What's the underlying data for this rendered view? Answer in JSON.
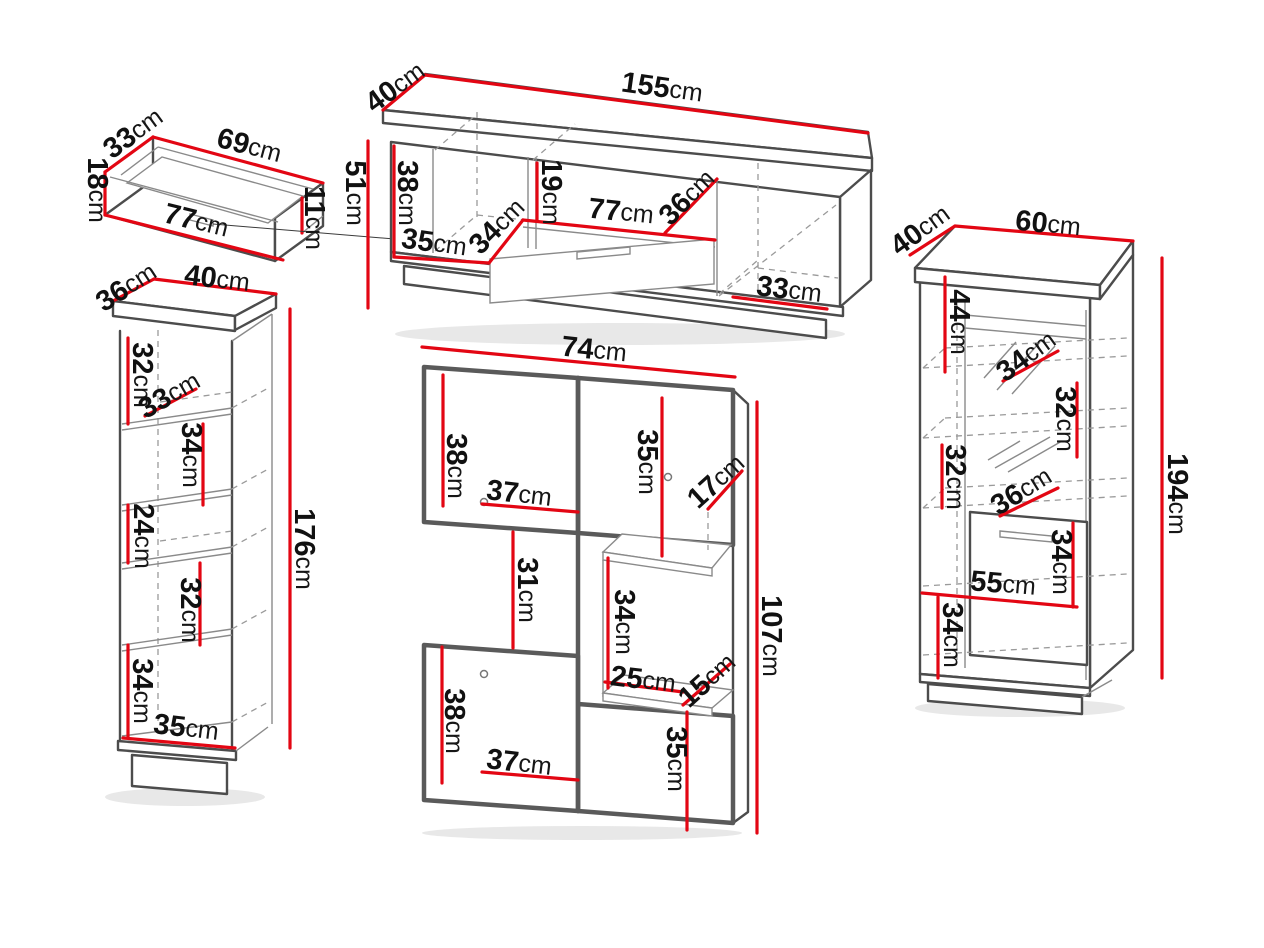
{
  "title": "Furniture wall unit set dimension diagram",
  "unit": "cm",
  "colors": {
    "dimension_red": "#e30613",
    "outline_dark": "#4c4c4c",
    "outline_light": "#8a8a8a",
    "background": "#ffffff",
    "text": "#111111"
  },
  "pieces": {
    "wall_shelf": {
      "name": "wall shelf",
      "dims": {
        "depth": {
          "v": "33",
          "u": "cm"
        },
        "top_width": {
          "v": "69",
          "u": "cm"
        },
        "height": {
          "v": "18",
          "u": "cm"
        },
        "front_width": {
          "v": "77",
          "u": "cm"
        },
        "side_height": {
          "v": "11",
          "u": "cm"
        }
      }
    },
    "tv_stand": {
      "name": "TV stand",
      "dims": {
        "depth": {
          "v": "40",
          "u": "cm"
        },
        "width": {
          "v": "155",
          "u": "cm"
        },
        "height": {
          "v": "51",
          "u": "cm"
        },
        "inner_height": {
          "v": "38",
          "u": "cm"
        },
        "left_width": {
          "v": "35",
          "u": "cm"
        },
        "left_depth": {
          "v": "34",
          "u": "cm"
        },
        "niche_height": {
          "v": "19",
          "u": "cm"
        },
        "niche_width": {
          "v": "77",
          "u": "cm"
        },
        "right_depth": {
          "v": "36",
          "u": "cm"
        },
        "right_width": {
          "v": "33",
          "u": "cm"
        }
      }
    },
    "bookcase": {
      "name": "open bookcase",
      "dims": {
        "depth": {
          "v": "36",
          "u": "cm"
        },
        "width": {
          "v": "40",
          "u": "cm"
        },
        "sec1_height": {
          "v": "32",
          "u": "cm"
        },
        "shelf_depth": {
          "v": "33",
          "u": "cm"
        },
        "sec2_height": {
          "v": "34",
          "u": "cm"
        },
        "sec3_height": {
          "v": "24",
          "u": "cm"
        },
        "sec4_height": {
          "v": "32",
          "u": "cm"
        },
        "sec5_height": {
          "v": "34",
          "u": "cm"
        },
        "interior_width": {
          "v": "35",
          "u": "cm"
        },
        "height": {
          "v": "176",
          "u": "cm"
        }
      }
    },
    "wall_unit": {
      "name": "hanging wall unit",
      "dims": {
        "width": {
          "v": "74",
          "u": "cm"
        },
        "top_door_height": {
          "v": "38",
          "u": "cm"
        },
        "top_door_width": {
          "v": "37",
          "u": "cm"
        },
        "right_top_height": {
          "v": "35",
          "u": "cm"
        },
        "top_depth": {
          "v": "17",
          "u": "cm"
        },
        "gap_height": {
          "v": "31",
          "u": "cm"
        },
        "niche_height": {
          "v": "34",
          "u": "cm"
        },
        "niche_width": {
          "v": "25",
          "u": "cm"
        },
        "niche_depth": {
          "v": "15",
          "u": "cm"
        },
        "bottom_door_height": {
          "v": "38",
          "u": "cm"
        },
        "bottom_door_width": {
          "v": "37",
          "u": "cm"
        },
        "right_bottom_height": {
          "v": "35",
          "u": "cm"
        },
        "height": {
          "v": "107",
          "u": "cm"
        }
      }
    },
    "display_cabinet": {
      "name": "display cabinet",
      "dims": {
        "depth": {
          "v": "40",
          "u": "cm"
        },
        "width": {
          "v": "60",
          "u": "cm"
        },
        "top_section": {
          "v": "44",
          "u": "cm"
        },
        "shelf_depth": {
          "v": "34",
          "u": "cm"
        },
        "glass1_height": {
          "v": "32",
          "u": "cm"
        },
        "glass2_height": {
          "v": "32",
          "u": "cm"
        },
        "lower_shelf_depth": {
          "v": "36",
          "u": "cm"
        },
        "door_height": {
          "v": "34",
          "u": "cm"
        },
        "interior_width": {
          "v": "55",
          "u": "cm"
        },
        "base_height": {
          "v": "34",
          "u": "cm"
        },
        "height": {
          "v": "194",
          "u": "cm"
        }
      }
    }
  }
}
